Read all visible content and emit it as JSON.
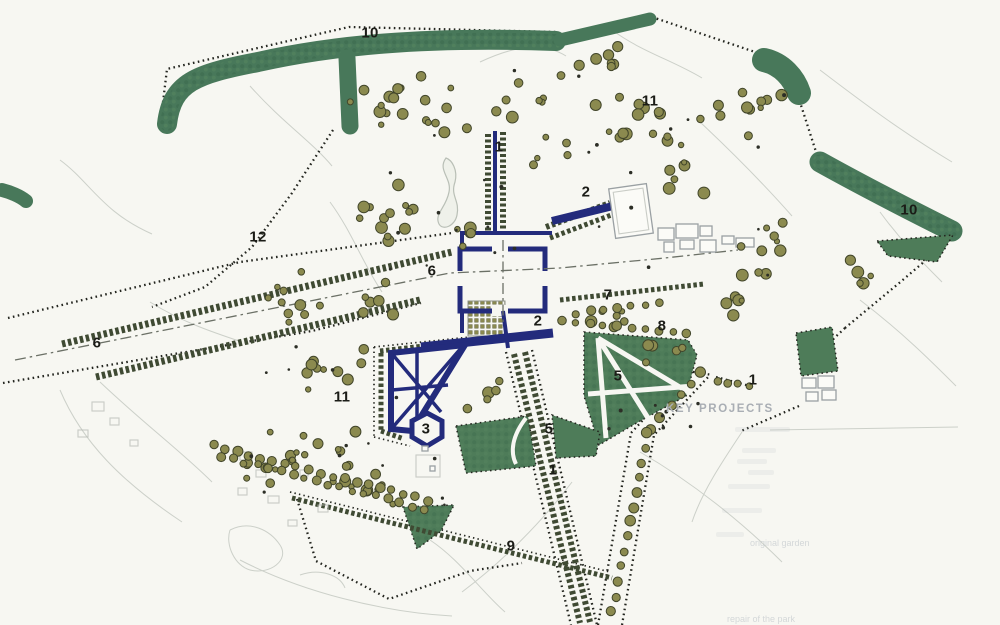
{
  "colors": {
    "background": "#f7f7f2",
    "woodland_green": "#48785a",
    "pleasure_green": "#4e7c59",
    "tree_olive": "#8b8a4f",
    "tree_outline": "#41452a",
    "avenue_hatch": "#3f4a33",
    "navy": "#232b7c",
    "boundary_black": "#23251f",
    "building_gray": "#9aa0a3",
    "legend_gray": "#a9aeb4"
  },
  "map": {
    "labels": [
      {
        "text": "10",
        "cx": 370,
        "cy": 33
      },
      {
        "text": "11",
        "cx": 650,
        "cy": 101
      },
      {
        "text": "1",
        "cx": 499,
        "cy": 147
      },
      {
        "text": "2",
        "cx": 586,
        "cy": 192
      },
      {
        "text": "10",
        "cx": 909,
        "cy": 210
      },
      {
        "text": "12",
        "cx": 258,
        "cy": 237
      },
      {
        "text": "6",
        "cx": 432,
        "cy": 271
      },
      {
        "text": "7",
        "cx": 608,
        "cy": 295
      },
      {
        "text": "2",
        "cx": 538,
        "cy": 321
      },
      {
        "text": "8",
        "cx": 662,
        "cy": 326
      },
      {
        "text": "6",
        "cx": 97,
        "cy": 343
      },
      {
        "text": "5",
        "cx": 618,
        "cy": 376
      },
      {
        "text": "1",
        "cx": 753,
        "cy": 380
      },
      {
        "text": "11",
        "cx": 342,
        "cy": 397
      },
      {
        "text": "3",
        "cx": 426,
        "cy": 429
      },
      {
        "text": "5",
        "cx": 549,
        "cy": 429
      },
      {
        "text": "1",
        "cx": 553,
        "cy": 470
      },
      {
        "text": "9",
        "cx": 511,
        "cy": 546
      }
    ],
    "legend": {
      "heading": "KEY PROJECTS",
      "faint_fragments": [
        {
          "text": "original garden",
          "x": 750,
          "y": 538
        },
        {
          "text": "repair of the park",
          "x": 727,
          "y": 614
        }
      ]
    }
  }
}
